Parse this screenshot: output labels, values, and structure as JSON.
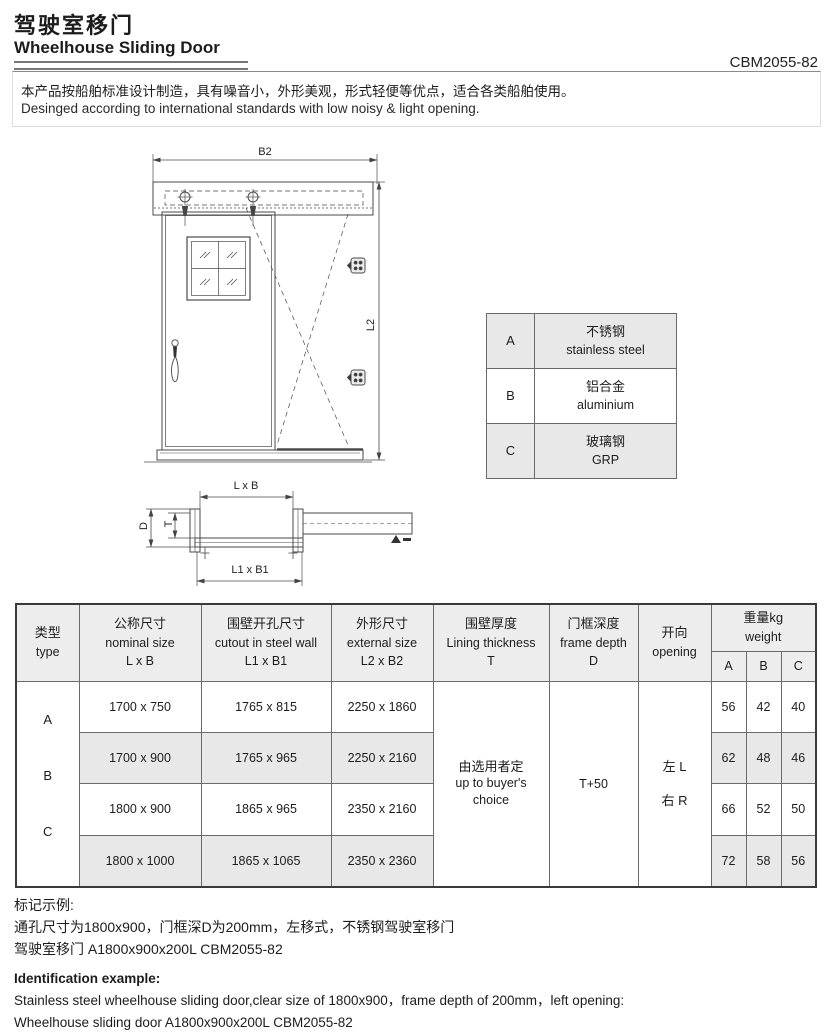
{
  "header": {
    "title_zh": "驾驶室移门",
    "title_en": "Wheelhouse Sliding Door",
    "doc_code": "CBM2055-82",
    "desc_zh": "本产品按船舶标准设计制造，具有噪音小，外形美观，形式轻便等优点，适合各类船舶使用。",
    "desc_en": "Desinged according to international standards with low noisy & light opening."
  },
  "drawing": {
    "dim_b2": "B2",
    "dim_l2": "L2",
    "dim_lxb": "L x B",
    "dim_l1xb1": "L1 x B1",
    "dim_d": "D",
    "dim_t": "T"
  },
  "material_table": {
    "rows": [
      {
        "key": "A",
        "name_zh": "不锈钢",
        "name_en": "stainless steel"
      },
      {
        "key": "B",
        "name_zh": "铝合金",
        "name_en": "aluminium"
      },
      {
        "key": "C",
        "name_zh": "玻璃钢",
        "name_en": "GRP"
      }
    ]
  },
  "spec_table": {
    "headers": {
      "type_zh": "类型",
      "type_en": "type",
      "nominal_zh": "公称尺寸",
      "nominal_en": "nominal size",
      "nominal_sym": "L x B",
      "cutout_zh": "围壁开孔尺寸",
      "cutout_en": "cutout in steel wall",
      "cutout_sym": "L1 x B1",
      "external_zh": "外形尺寸",
      "external_en": "external size",
      "external_sym": "L2 x B2",
      "lining_zh": "围壁厚度",
      "lining_en": "Lining thickness",
      "lining_sym": "T",
      "frame_zh": "门框深度",
      "frame_en": "frame depth",
      "frame_sym": "D",
      "opening_zh": "开向",
      "opening_en": "opening",
      "weight_zh": "重量kg",
      "weight_en": "weight",
      "wcol_a": "A",
      "wcol_b": "B",
      "wcol_c": "C"
    },
    "type_letters": {
      "a": "A",
      "b": "B",
      "c": "C"
    },
    "rows": [
      {
        "nominal": "1700 x 750",
        "cutout": "1765 x 815",
        "external": "2250 x 1860",
        "wa": "56",
        "wb": "42",
        "wc": "40"
      },
      {
        "nominal": "1700 x 900",
        "cutout": "1765 x 965",
        "external": "2250 x 2160",
        "wa": "62",
        "wb": "48",
        "wc": "46"
      },
      {
        "nominal": "1800 x 900",
        "cutout": "1865 x 965",
        "external": "2350 x 2160",
        "wa": "66",
        "wb": "52",
        "wc": "50"
      },
      {
        "nominal": "1800 x 1000",
        "cutout": "1865 x 1065",
        "external": "2350 x 2360",
        "wa": "72",
        "wb": "58",
        "wc": "56"
      }
    ],
    "merged": {
      "lining_zh": "由选用者定",
      "lining_en": "up to buyer's choice",
      "frame_depth": "T+50",
      "opening_left": "左 L",
      "opening_right": "右 R"
    }
  },
  "notes": {
    "zh_title": "标记示例:",
    "zh_line1": "通孔尺寸为1800x900，门框深D为200mm，左移式，不锈钢驾驶室移门",
    "zh_line2": "驾驶室移门 A1800x900x200L CBM2055-82",
    "en_title": "Identification example:",
    "en_line1": "Stainless steel wheelhouse sliding door,clear size of 1800x900，frame depth of 200mm，left opening:",
    "en_line2": "Wheelhouse sliding door A1800x900x200L CBM2055-82"
  },
  "colors": {
    "stripe": "#e8e8e8",
    "line": "#4a4a4a",
    "text": "#1c1c1c"
  }
}
